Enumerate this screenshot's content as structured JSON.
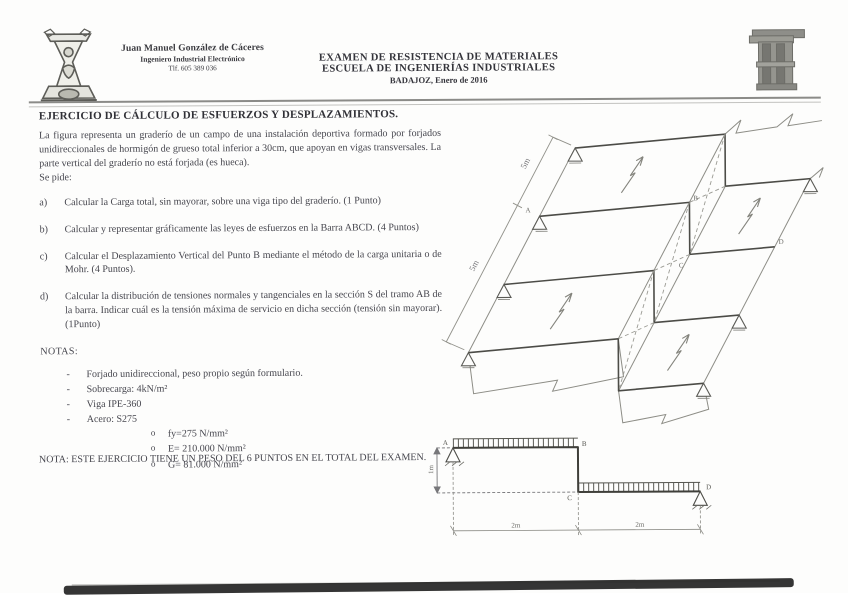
{
  "header": {
    "author": {
      "name": "Juan Manuel González de Cáceres",
      "role": "Ingeniero Industrial Electrónico",
      "phone": "Tlf. 605 389 036"
    },
    "exam": {
      "line1": "EXAMEN DE RESISTENCIA DE MATERIALES",
      "line2": "ESCUELA DE INGENIERÍAS INDUSTRIALES",
      "line3": "BADAJOZ, Enero de 2016"
    }
  },
  "body": {
    "title": "EJERCICIO DE CÁLCULO DE ESFUERZOS Y DESPLAZAMIENTOS.",
    "intro": "La figura representa un graderío de un campo de una instalación deportiva formado por forjados unidireccionales de hormigón de grueso total inferior a 30cm,  que apoyan en vigas transversales. La parte vertical del graderío no está forjada (es hueca).",
    "se_pide": "Se pide:",
    "items": [
      {
        "label": "a)",
        "text": "Calcular la Carga total, sin mayorar, sobre una viga tipo del graderío. (1 Punto)"
      },
      {
        "label": "b)",
        "text": "Calcular y representar gráficamente las leyes de esfuerzos en la Barra ABCD. (4 Puntos)"
      },
      {
        "label": "c)",
        "text": "Calcular el Desplazamiento Vertical del Punto B mediante el método de la carga unitaria o de Mohr. (4 Puntos)."
      },
      {
        "label": "d)",
        "text": "Calcular la distribución de tensiones normales y tangenciales en la sección S del tramo AB de la barra. Indicar cuál es la tensión máxima de servicio en dicha sección (tensión sin mayorar). (1Punto)"
      }
    ],
    "dash_marker": "-",
    "circle_marker": "o",
    "notas_title": "NOTAS:",
    "notas": [
      "Forjado unidireccional, peso propio según formulario.",
      "Sobrecarga: 4kN/m²",
      "Viga IPE-360",
      "Acero: S275"
    ],
    "acero_sub": [
      "fy=275 N/mm²",
      "E= 210.000 N/mm²",
      "G= 81.000 N/mm²"
    ],
    "footer_note": "NOTA: ESTE EJERCICIO TIENE UN PESO DEL 6 PUNTOS EN EL TOTAL DEL EXAMEN."
  },
  "figure3d": {
    "dim_labels": [
      "5m",
      "5m"
    ],
    "points": {
      "a": "A",
      "b": "B",
      "c": "C",
      "d": "D"
    }
  },
  "figure2d": {
    "points": {
      "a": "A",
      "b": "B",
      "c": "C",
      "d": "D"
    },
    "dim_height": "1m",
    "dim_span1": "2m",
    "dim_span2": "2m"
  }
}
